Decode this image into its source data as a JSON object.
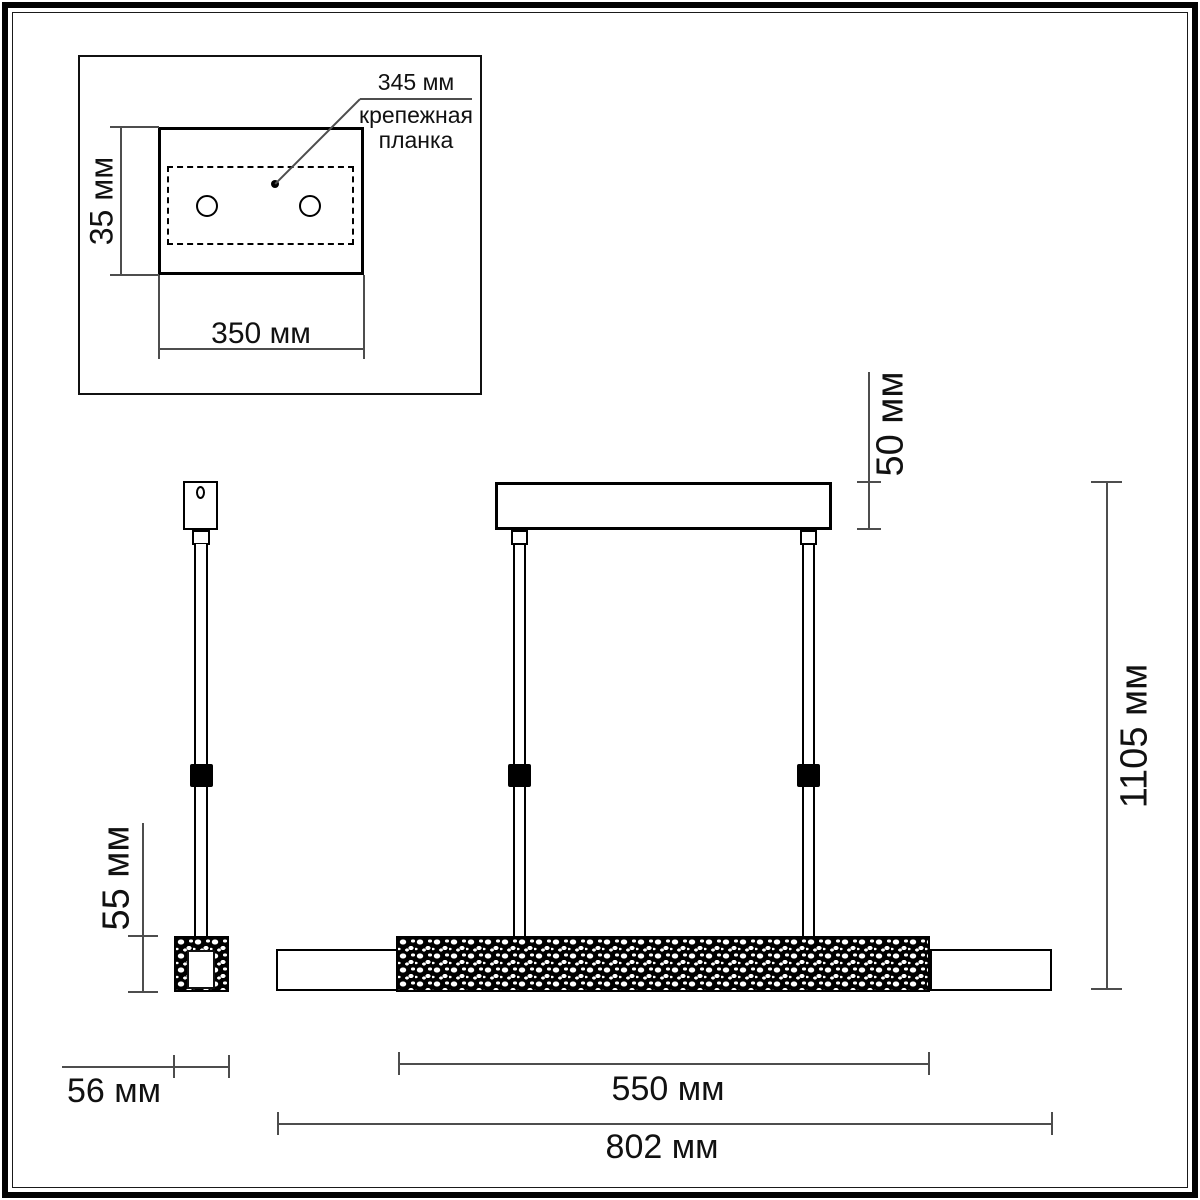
{
  "drawing": {
    "inset": {
      "plate_length_label": "345 мм",
      "plate_caption_line1": "крепежная",
      "plate_caption_line2": "планка",
      "plate_height_label": "35 мм",
      "plate_width_label": "350 мм"
    },
    "side_view": {
      "bar_height_label": "55 мм",
      "bar_depth_label": "56 мм"
    },
    "front_view": {
      "canopy_height_label": "50 мм",
      "overall_height_label": "1105 мм",
      "diffuser_length_label": "550 мм",
      "overall_length_label": "802 мм"
    },
    "colors": {
      "stroke": "#000000",
      "dimension_line": "#4d4d4d",
      "text": "#111111",
      "background": "#ffffff"
    }
  }
}
